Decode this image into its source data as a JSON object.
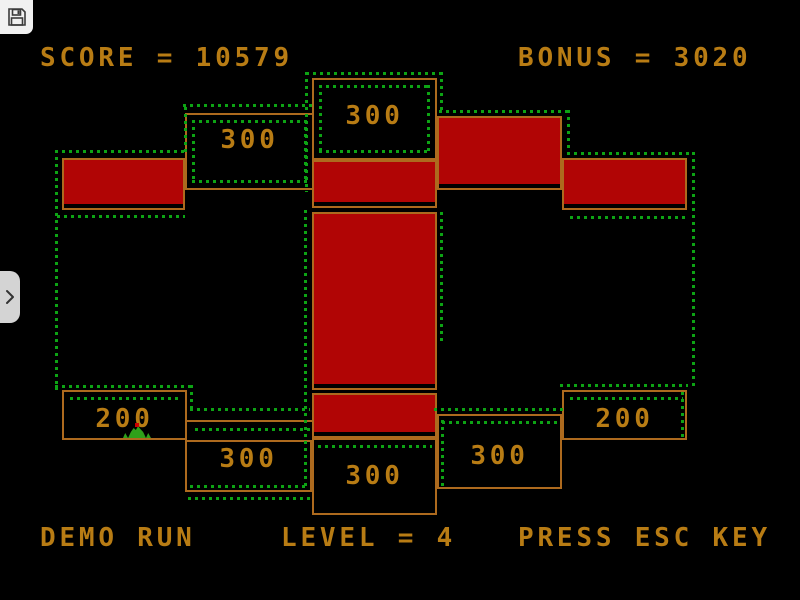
{
  "overlay": {
    "save_button": {
      "icon": "floppy-disk"
    },
    "drawer": {
      "icon": "chevron-right"
    }
  },
  "hud": {
    "score": "SCORE = 10579",
    "bonus": "BONUS = 3020"
  },
  "status": {
    "demo": "DEMO RUN",
    "level": "LEVEL = 4",
    "esc_hint": "PRESS ESC KEY"
  },
  "colors": {
    "bg": "#000000",
    "text": "#b87c14",
    "wall": "#ad6a1e",
    "red": "#b10505",
    "dots": "#0da314",
    "player": "#2fa01a",
    "red_dot": "#cc0000",
    "save_bg": "#f1f1f1",
    "icon_dark": "#3c3c3c",
    "tab_bg": "#d4d4d4"
  },
  "game": {
    "score_boxes": [
      {
        "id": "top-center",
        "label": "300",
        "x": 312,
        "y": 78,
        "w": 125,
        "h": 82,
        "label_top": 24,
        "inner": true
      },
      {
        "id": "top-left",
        "label": "300",
        "x": 185,
        "y": 113,
        "w": 129,
        "h": 77,
        "label_top": 13,
        "inner": true
      },
      {
        "id": "bottom-left-200",
        "label": "200",
        "x": 62,
        "y": 390,
        "w": 125,
        "h": 50,
        "label_top": 15,
        "inner": false
      },
      {
        "id": "bottom-left-300",
        "label": "300",
        "x": 185,
        "y": 440,
        "w": 127,
        "h": 52,
        "label_top": 5,
        "inner": false
      },
      {
        "id": "bottom-center",
        "label": "300",
        "x": 312,
        "y": 438,
        "w": 125,
        "h": 77,
        "label_top": 24,
        "inner": false
      },
      {
        "id": "bottom-right-300",
        "label": "300",
        "x": 437,
        "y": 414,
        "w": 125,
        "h": 75,
        "label_top": 28,
        "inner": false
      },
      {
        "id": "bottom-right-200",
        "label": "200",
        "x": 562,
        "y": 390,
        "w": 125,
        "h": 50,
        "label_top": 15,
        "inner": false
      }
    ],
    "red_blocks": [
      {
        "x": 62,
        "y": 158,
        "w": 123,
        "h": 52
      },
      {
        "x": 312,
        "y": 160,
        "w": 125,
        "h": 48
      },
      {
        "x": 437,
        "y": 116,
        "w": 125,
        "h": 74
      },
      {
        "x": 562,
        "y": 158,
        "w": 125,
        "h": 52
      },
      {
        "x": 312,
        "y": 212,
        "w": 125,
        "h": 178
      },
      {
        "x": 312,
        "y": 393,
        "w": 125,
        "h": 45
      }
    ],
    "walls": [
      {
        "x": 185,
        "y": 420,
        "w": 127,
        "h": 2
      }
    ],
    "dots_h": [
      [
        150,
        55,
        185
      ],
      [
        104,
        183,
        312
      ],
      [
        72,
        306,
        441
      ],
      [
        110,
        439,
        567
      ],
      [
        152,
        567,
        694
      ],
      [
        215,
        57,
        185
      ],
      [
        216,
        570,
        689
      ],
      [
        385,
        55,
        190
      ],
      [
        397,
        70,
        182
      ],
      [
        408,
        190,
        310
      ],
      [
        428,
        195,
        310
      ],
      [
        485,
        190,
        308
      ],
      [
        497,
        188,
        310
      ],
      [
        445,
        318,
        432
      ],
      [
        384,
        560,
        688
      ],
      [
        397,
        570,
        683
      ],
      [
        408,
        434,
        564
      ],
      [
        421,
        442,
        558
      ]
    ],
    "dots_v": [
      [
        55,
        150,
        390
      ],
      [
        184,
        107,
        152
      ],
      [
        305,
        72,
        192
      ],
      [
        304,
        210,
        490
      ],
      [
        440,
        72,
        112
      ],
      [
        567,
        110,
        152
      ],
      [
        692,
        152,
        390
      ],
      [
        440,
        212,
        345
      ],
      [
        441,
        420,
        487
      ],
      [
        190,
        385,
        410
      ],
      [
        681,
        392,
        438
      ]
    ],
    "player": {
      "x": 123,
      "y": 425,
      "w": 28,
      "h": 13,
      "dot": {
        "x": 135,
        "y": 423,
        "w": 4,
        "h": 4
      }
    }
  }
}
